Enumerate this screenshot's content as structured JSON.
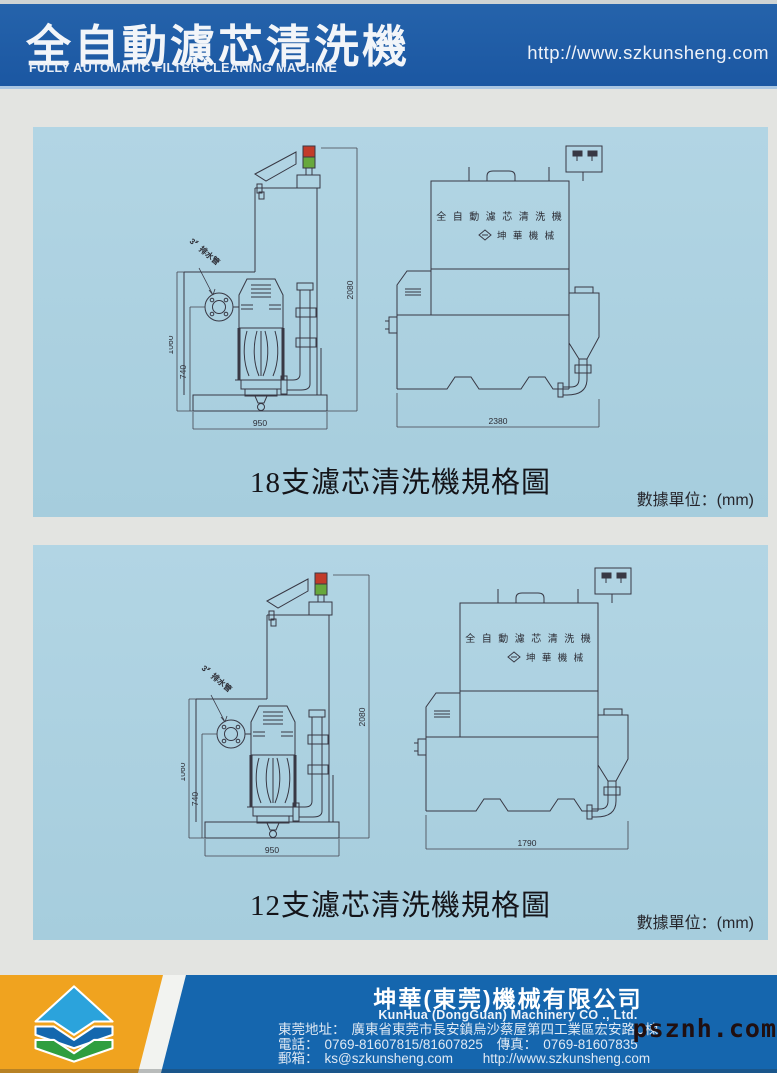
{
  "header": {
    "title": "全自動濾芯清洗機",
    "subtitle": "FULLY AUTOMATIC FILTER CLEANING MACHINE",
    "url": "http://www.szkunsheng.com"
  },
  "panels": [
    {
      "caption": "18支濾芯清洗機規格圖",
      "unit_label": "數據單位：(mm)",
      "machine_label": "全 自 動 濾 芯 清 洗 機",
      "brand_label": "坤 華 機 械",
      "side_view": {
        "height": "2080",
        "left_height": "1060",
        "inner_height": "740",
        "width": "950",
        "drain_label": "3〞排水管"
      },
      "front_view": {
        "width": "2380"
      }
    },
    {
      "caption": "12支濾芯清洗機規格圖",
      "unit_label": "數據單位：(mm)",
      "machine_label": "全 自 動 濾 芯 清 洗 機",
      "brand_label": "坤 華 機 械",
      "side_view": {
        "height": "2080",
        "left_height": "1060",
        "inner_height": "740",
        "width": "950",
        "drain_label": "3〞排水管"
      },
      "front_view": {
        "width": "1790"
      }
    }
  ],
  "footer": {
    "company_zh": "坤華(東莞)機械有限公司",
    "company_en": "KunHua (DongGuan) Machinery CO ., Ltd.",
    "address_label": "東莞地址：",
    "address": "廣東省東莞市長安鎮烏沙蔡屋第四工業區宏安路C棟",
    "phone_label": "電話：",
    "phone": "0769-81607815/81607825",
    "fax_label": "傳真：",
    "fax": "0769-81607835",
    "email_label": "郵箱：",
    "email": "ks@szkunsheng.com",
    "website": "http://www.szkunsheng.com"
  },
  "watermark": "psznh.com",
  "colors": {
    "header_blue": "#1b57a2",
    "panel_blue": "#a9cede",
    "footer_blue": "#1566ae",
    "footer_orange": "#f0a31f",
    "lamp_red": "#c23b2a",
    "lamp_green": "#67a83c",
    "logo_light_blue": "#2ba3dc",
    "logo_blue": "#1467ae",
    "logo_green": "#2f9e3f"
  }
}
